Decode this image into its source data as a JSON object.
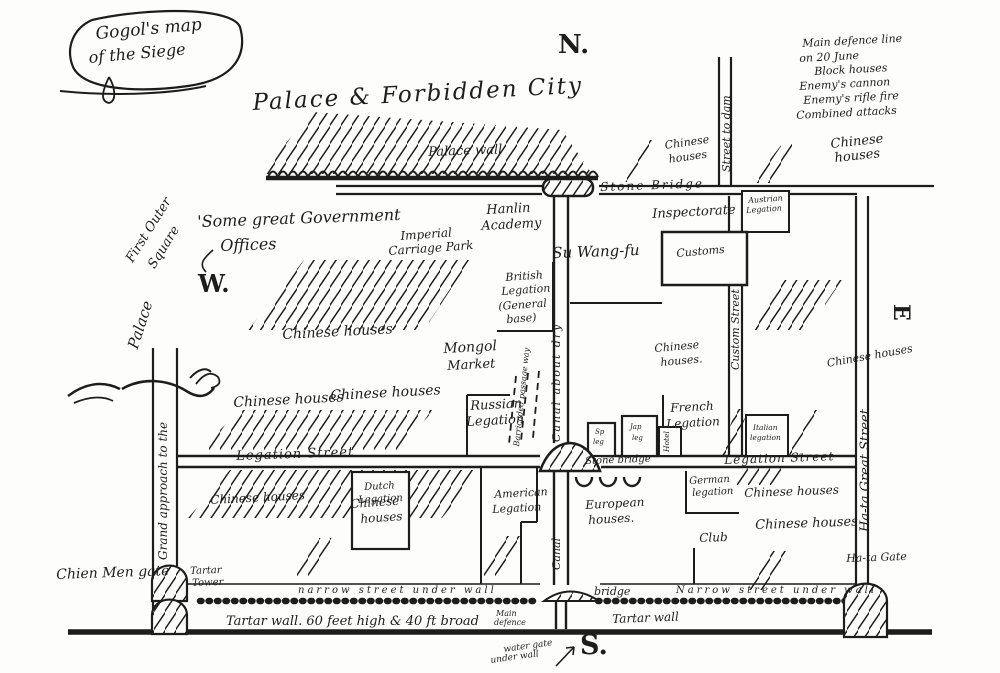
{
  "colors": {
    "ink": "#1d1d1d",
    "paper": "#fdfdfb"
  },
  "title": {
    "line1": "Gogol's map",
    "line2": "of the Siege"
  },
  "compass": {
    "north": "N.",
    "south": "S.",
    "east": "E",
    "west": "W."
  },
  "legend": {
    "items": [
      "Main defence line",
      "on 20 June",
      "Block houses",
      "Enemy's cannon",
      "Enemy's rifle fire",
      "Combined attacks"
    ]
  },
  "labels": {
    "palace_city": "Palace & Forbidden City",
    "palace_wall": "Palace wall",
    "stone_bridge_top": "Stone Bridge",
    "street_to_dam": "Street to dam",
    "ch_tr1_l1": "Chinese",
    "ch_tr1_l2": "houses",
    "ch_tr2_l1": "Chinese",
    "ch_tr2_l2": "houses",
    "austrian_l1": "Austrian",
    "austrian_l2": "Legation",
    "hanlin_l1": "Hanlin",
    "hanlin_l2": "Academy",
    "inspectorate": "Inspectorate",
    "su_wang_fu": "Su Wang-fu",
    "customs": "Customs",
    "custom_street": "Custom Street",
    "govt_l1": "'Some great Government",
    "govt_l2": "Offices",
    "imperial_l1": "Imperial",
    "imperial_l2": "Carriage Park",
    "chinese_mid": "Chinese houses",
    "british_l1": "British",
    "british_l2": "Legation",
    "british_l3": "(General",
    "british_l4": "base)",
    "mongol_l1": "Mongol",
    "mongol_l2": "Market",
    "barricaded": "Barricaded passage way",
    "canal_dry": "Canal about dry",
    "canal": "Canal",
    "ch_r1_l1": "Chinese",
    "ch_r1_l2": "houses.",
    "ch_r2": "Chinese houses",
    "outer_sq_l1": "First Outer",
    "outer_sq_l2": "Square",
    "palace_left": "Palace",
    "grand_approach": "Grand approach to the",
    "ch_row_1": "Chinese houses",
    "ch_row_2": "Chinese houses",
    "legation_street_w": "Legation Street",
    "legation_street_e": "Legation Street",
    "stone_bridge_mid": "Stone bridge",
    "sp_l1": "Sp",
    "sp_l2": "leg",
    "jap_l1": "Jap",
    "jap_l2": "leg",
    "hotel": "Hotel",
    "french_l1": "French",
    "french_l2": "Legation",
    "italian_l1": "Italian",
    "italian_l2": "legation",
    "russian_l1": "Russian",
    "russian_l2": "Legation",
    "ch_bl": "Chinese houses",
    "ch_bl2_l1": "Chinese",
    "ch_bl2_l2": "houses",
    "dutch_l1": "Dutch",
    "dutch_l2": "Legation",
    "american_l1": "American",
    "american_l2": "Legation",
    "european_l1": "European",
    "european_l2": "houses.",
    "german_l1": "German",
    "german_l2": "legation",
    "club": "Club",
    "ch_br1": "Chinese houses",
    "ch_br2": "Chinese houses",
    "hata_street": "Ha-ta Great Street",
    "hata_gate": "Ha-ta Gate",
    "chien_men": "Chien Men gate",
    "tartar_tower_l1": "Tartar",
    "tartar_tower_l2": "Tower",
    "narrow_w": "narrow street under wall",
    "bridge_s": "bridge",
    "narrow_e": "Narrow street under wall",
    "main_def_l1": "Main",
    "main_def_l2": "defence",
    "tartar_wall_e": "Tartar wall",
    "tartar_wall_main": "Tartar wall. 60 feet high & 40 ft broad",
    "water_gate_l1": "water gate",
    "water_gate_l2": "under wall"
  }
}
